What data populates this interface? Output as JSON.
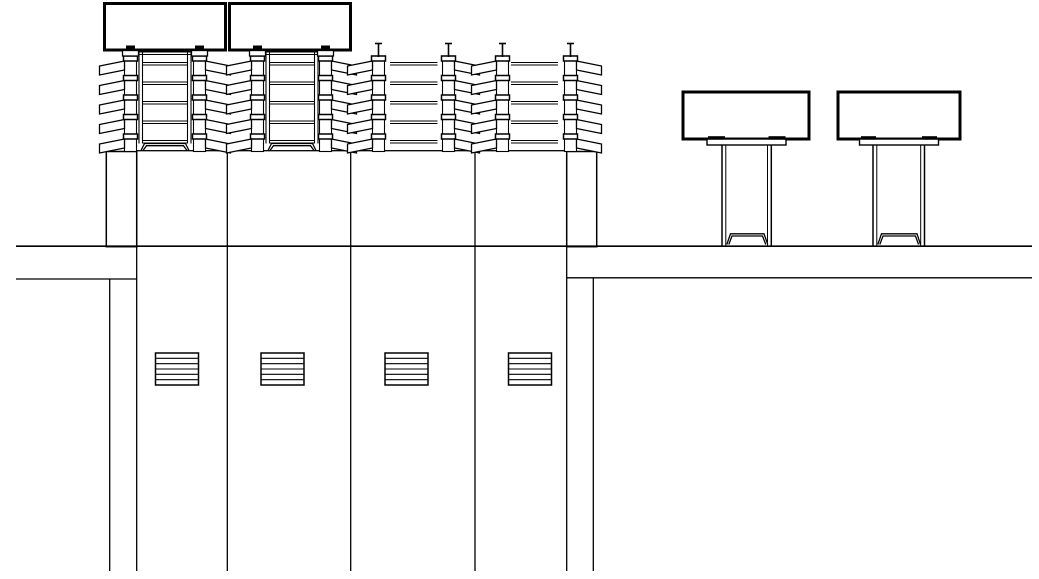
{
  "canvas": {
    "width": 1039,
    "height": 579,
    "background": "#ffffff",
    "line_color": "#000000"
  },
  "equipment_boxes": [
    {
      "x": 104.5,
      "y": 3.5,
      "w": 121,
      "h": 46.5,
      "stroke_width": 3
    },
    {
      "x": 229.5,
      "y": 3.5,
      "w": 121,
      "h": 46.5,
      "stroke_width": 3
    }
  ],
  "insulator_stacks": {
    "geometry": {
      "core_half_width": 6,
      "core_top": 56,
      "core_bottom": 151.5,
      "level_tops": [
        56,
        75.5,
        95,
        114.5,
        134
      ],
      "level_rect_half_width": 7,
      "level_rect_height": 5,
      "shed_reach": 31,
      "shed_top_drop": 5,
      "shed_outer_top": 10,
      "shed_outer_bottom": 19,
      "shed_core_bottom": 14,
      "pin_top_y": 43.5,
      "pin_serif_half_width": 3.5,
      "pad_half_width": 4.5,
      "pad_top": 45.5,
      "pad_height": 5.5,
      "plate_half_width": 8,
      "plate_top": 50.5,
      "plate_height": 5.5
    },
    "items": [
      {
        "cx": 130.5,
        "shed_dir": -1,
        "top_fitting": "box"
      },
      {
        "cx": 199.5,
        "shed_dir": 1,
        "top_fitting": "box"
      },
      {
        "cx": 257.5,
        "shed_dir": -1,
        "top_fitting": "box"
      },
      {
        "cx": 325.5,
        "shed_dir": 1,
        "top_fitting": "box"
      },
      {
        "cx": 378.5,
        "shed_dir": -1,
        "top_fitting": "pin"
      },
      {
        "cx": 448.5,
        "shed_dir": 1,
        "top_fitting": "pin"
      },
      {
        "cx": 502.5,
        "shed_dir": -1,
        "top_fitting": "pin"
      },
      {
        "cx": 570.5,
        "shed_dir": 1,
        "top_fitting": "pin"
      }
    ]
  },
  "rail_levels_offset": [
    6.5,
    9
  ],
  "support_frames": [
    {
      "x_left": 139,
      "x_right": 191,
      "rail_thickness": 3.5,
      "top": 52,
      "bottom": 143.5,
      "base_bottom": 150.5
    },
    {
      "x_left": 266,
      "x_right": 318,
      "rail_thickness": 3.5,
      "top": 52,
      "bottom": 143.5,
      "base_bottom": 150.5
    }
  ],
  "connecting_rails": [
    {
      "x1": 390,
      "x2": 437.5
    },
    {
      "x1": 511,
      "x2": 558
    }
  ],
  "column_block": {
    "x": 136.7,
    "y": 150.7,
    "w": 430,
    "h": 95.5,
    "divider_xs": [
      227.3,
      350.7,
      475
    ]
  },
  "side_pedestals": [
    {
      "x": 106.3,
      "y": 151.5,
      "w": 30.4,
      "h": 95.2
    },
    {
      "x": 566.7,
      "y": 151.5,
      "w": 30,
      "h": 95.2
    }
  ],
  "piers": [
    {
      "box": {
        "x": 683,
        "y": 92,
        "w": 126,
        "h": 47
      },
      "plate": {
        "x": 707,
        "y": 139,
        "w": 79,
        "h": 6
      },
      "pad_y": 136.2,
      "pad_h": 3.4,
      "pads": [
        {
          "x": 708,
          "w": 17
        },
        {
          "x": 768.5,
          "w": 17
        }
      ],
      "post_xs": [
        722,
        725.8,
        767.5,
        771.3
      ],
      "post_top": 145,
      "post_bottom": 245.5,
      "base": {
        "x1": 726.8,
        "x2": 767.8,
        "top_x1": 730.5,
        "top_x2": 764,
        "top_y": 233.8,
        "bottom_y": 244.5
      }
    },
    {
      "box": {
        "x": 838,
        "y": 92,
        "w": 122,
        "h": 47
      },
      "plate": {
        "x": 859.5,
        "y": 139,
        "w": 79,
        "h": 6
      },
      "pad_y": 136.2,
      "pad_h": 3.4,
      "pads": [
        {
          "x": 861,
          "w": 15
        },
        {
          "x": 922,
          "w": 15
        }
      ],
      "post_xs": [
        873,
        876.8,
        920.7,
        924.5
      ],
      "post_top": 145,
      "post_bottom": 245.5,
      "base": {
        "x1": 877.8,
        "x2": 920.5,
        "top_x1": 881.5,
        "top_x2": 917,
        "top_y": 233.8,
        "bottom_y": 244.5
      }
    }
  ],
  "ground_line": {
    "y": 246.2,
    "x1": 16,
    "x2": 1032,
    "stroke_width": 1.6
  },
  "excavation_lines": [
    {
      "y": 279,
      "x1": 16,
      "x2": 136.7
    },
    {
      "y": 277.8,
      "x1": 566.7,
      "x2": 1032
    }
  ],
  "pile_lines": [
    {
      "x": 109.7,
      "y1": 279,
      "y2": 571
    },
    {
      "x": 136.7,
      "y1": 246.2,
      "y2": 571
    },
    {
      "x": 227.3,
      "y1": 246.2,
      "y2": 571
    },
    {
      "x": 350.7,
      "y1": 246.2,
      "y2": 571
    },
    {
      "x": 475,
      "y1": 246.2,
      "y2": 571
    },
    {
      "x": 566.7,
      "y1": 246.2,
      "y2": 571
    },
    {
      "x": 593.3,
      "y1": 277.8,
      "y2": 571
    }
  ],
  "hatch_symbols": {
    "y": 353,
    "w": 43,
    "h": 32,
    "inner_lines": 5,
    "xs": [
      155.5,
      261,
      385,
      508.5
    ]
  }
}
